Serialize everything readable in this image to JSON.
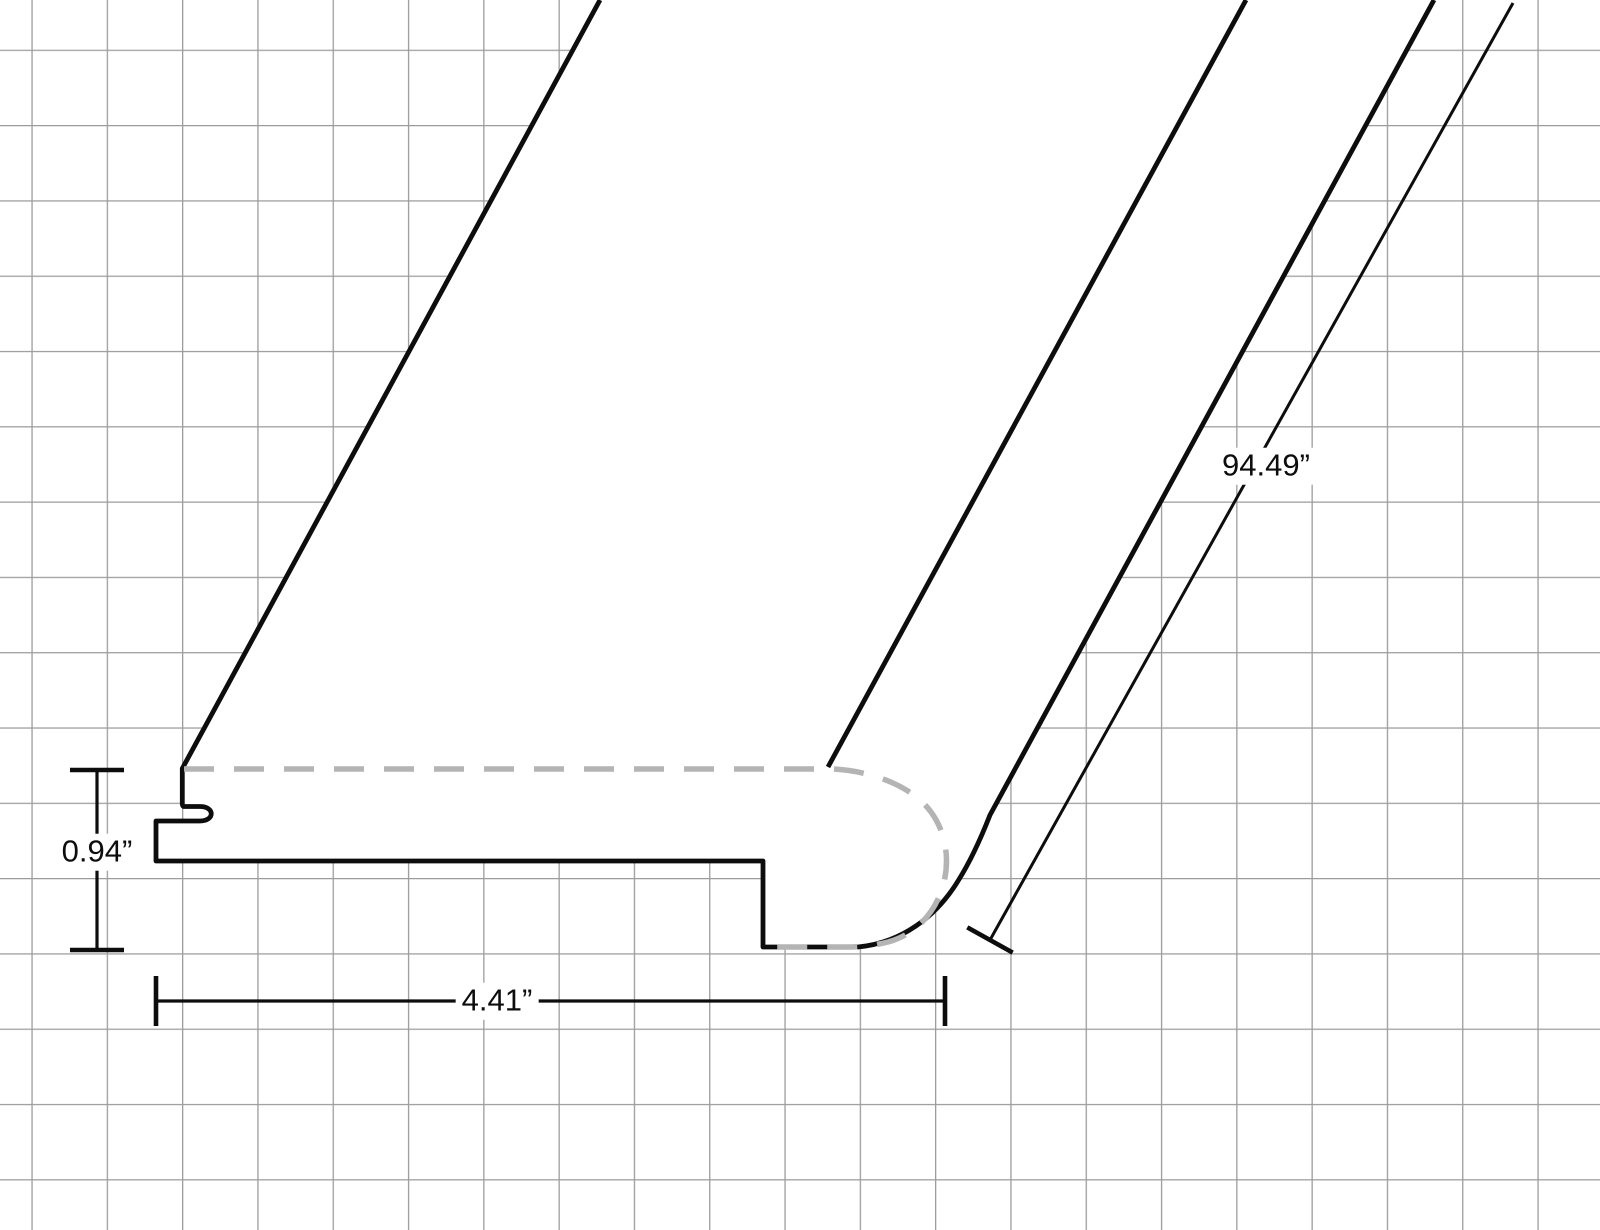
{
  "canvas": {
    "background_color": "#ffffff",
    "grid_color": "#9c9c9c",
    "outline_color": "#0d0d0d",
    "hidden_edge_color": "#b4b4b4"
  },
  "dimensions": {
    "height": {
      "label": "0.94”",
      "orientation": "vertical"
    },
    "width": {
      "label": "4.41”",
      "orientation": "horizontal"
    },
    "length": {
      "label": "94.49”",
      "orientation": "diagonal"
    }
  }
}
